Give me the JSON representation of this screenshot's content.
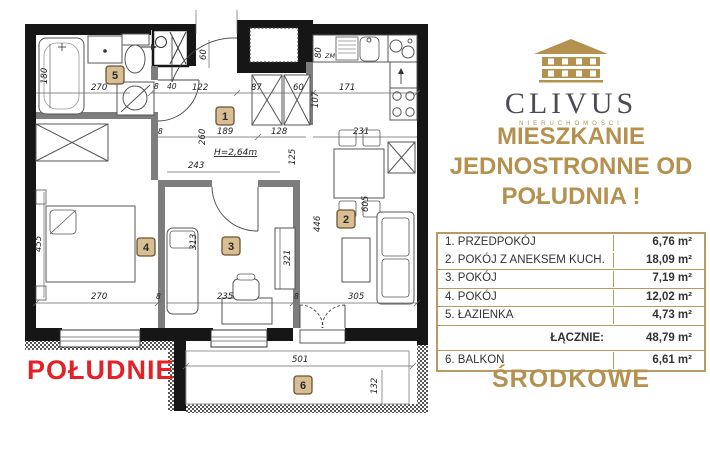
{
  "brand": {
    "name": "CLIVUS",
    "subtitle": "NIERUCHOMOŚCI"
  },
  "headline": {
    "line1": "MIESZKANIE",
    "line2": "JEDNOSTRONNE OD",
    "line3": "POŁUDNIA !"
  },
  "area_table": {
    "rows": [
      {
        "label": "1. PRZEDPOKÓJ",
        "value": "6,76 m²"
      },
      {
        "label": "2. POKÓJ Z ANEKSEM KUCH.",
        "value": "18,09 m²"
      },
      {
        "label": "3. POKÓJ",
        "value": "7,19 m²"
      },
      {
        "label": "4. POKÓJ",
        "value": "12,02 m²"
      },
      {
        "label": "5. ŁAZIENKA",
        "value": "4,73 m²"
      }
    ],
    "total_label": "ŁĄCZNIE:",
    "total_value": "48,79 m²",
    "balcony_label": "6. BALKON",
    "balcony_value": "6,61 m²"
  },
  "footer": {
    "south": "POŁUDNIE",
    "location": "ŚRODKOWE"
  },
  "plan": {
    "rooms": [
      "1",
      "2",
      "3",
      "4",
      "5",
      "6"
    ],
    "height_note": "H=2,64m",
    "dishwasher_label": "ZM",
    "dims": {
      "n8": "8",
      "n40": "40",
      "n60": "60",
      "n80": "80",
      "n87": "87",
      "n107": "107",
      "n122": "122",
      "n125": "125",
      "n128": "128",
      "n132": "132",
      "n171": "171",
      "n180": "180",
      "n189": "189",
      "n231": "231",
      "n235": "235",
      "n243": "243",
      "n260": "260",
      "n270": "270",
      "n305": "305",
      "n313": "313",
      "n321": "321",
      "n446": "446",
      "n455": "455",
      "n501": "501",
      "n605": "605"
    }
  },
  "colors": {
    "gold": "#b5914f",
    "table_border": "#b99a62",
    "red": "#e32227",
    "room_tag": "#d9bd93",
    "logo_text": "#4b4b52",
    "wall": "#161616"
  }
}
